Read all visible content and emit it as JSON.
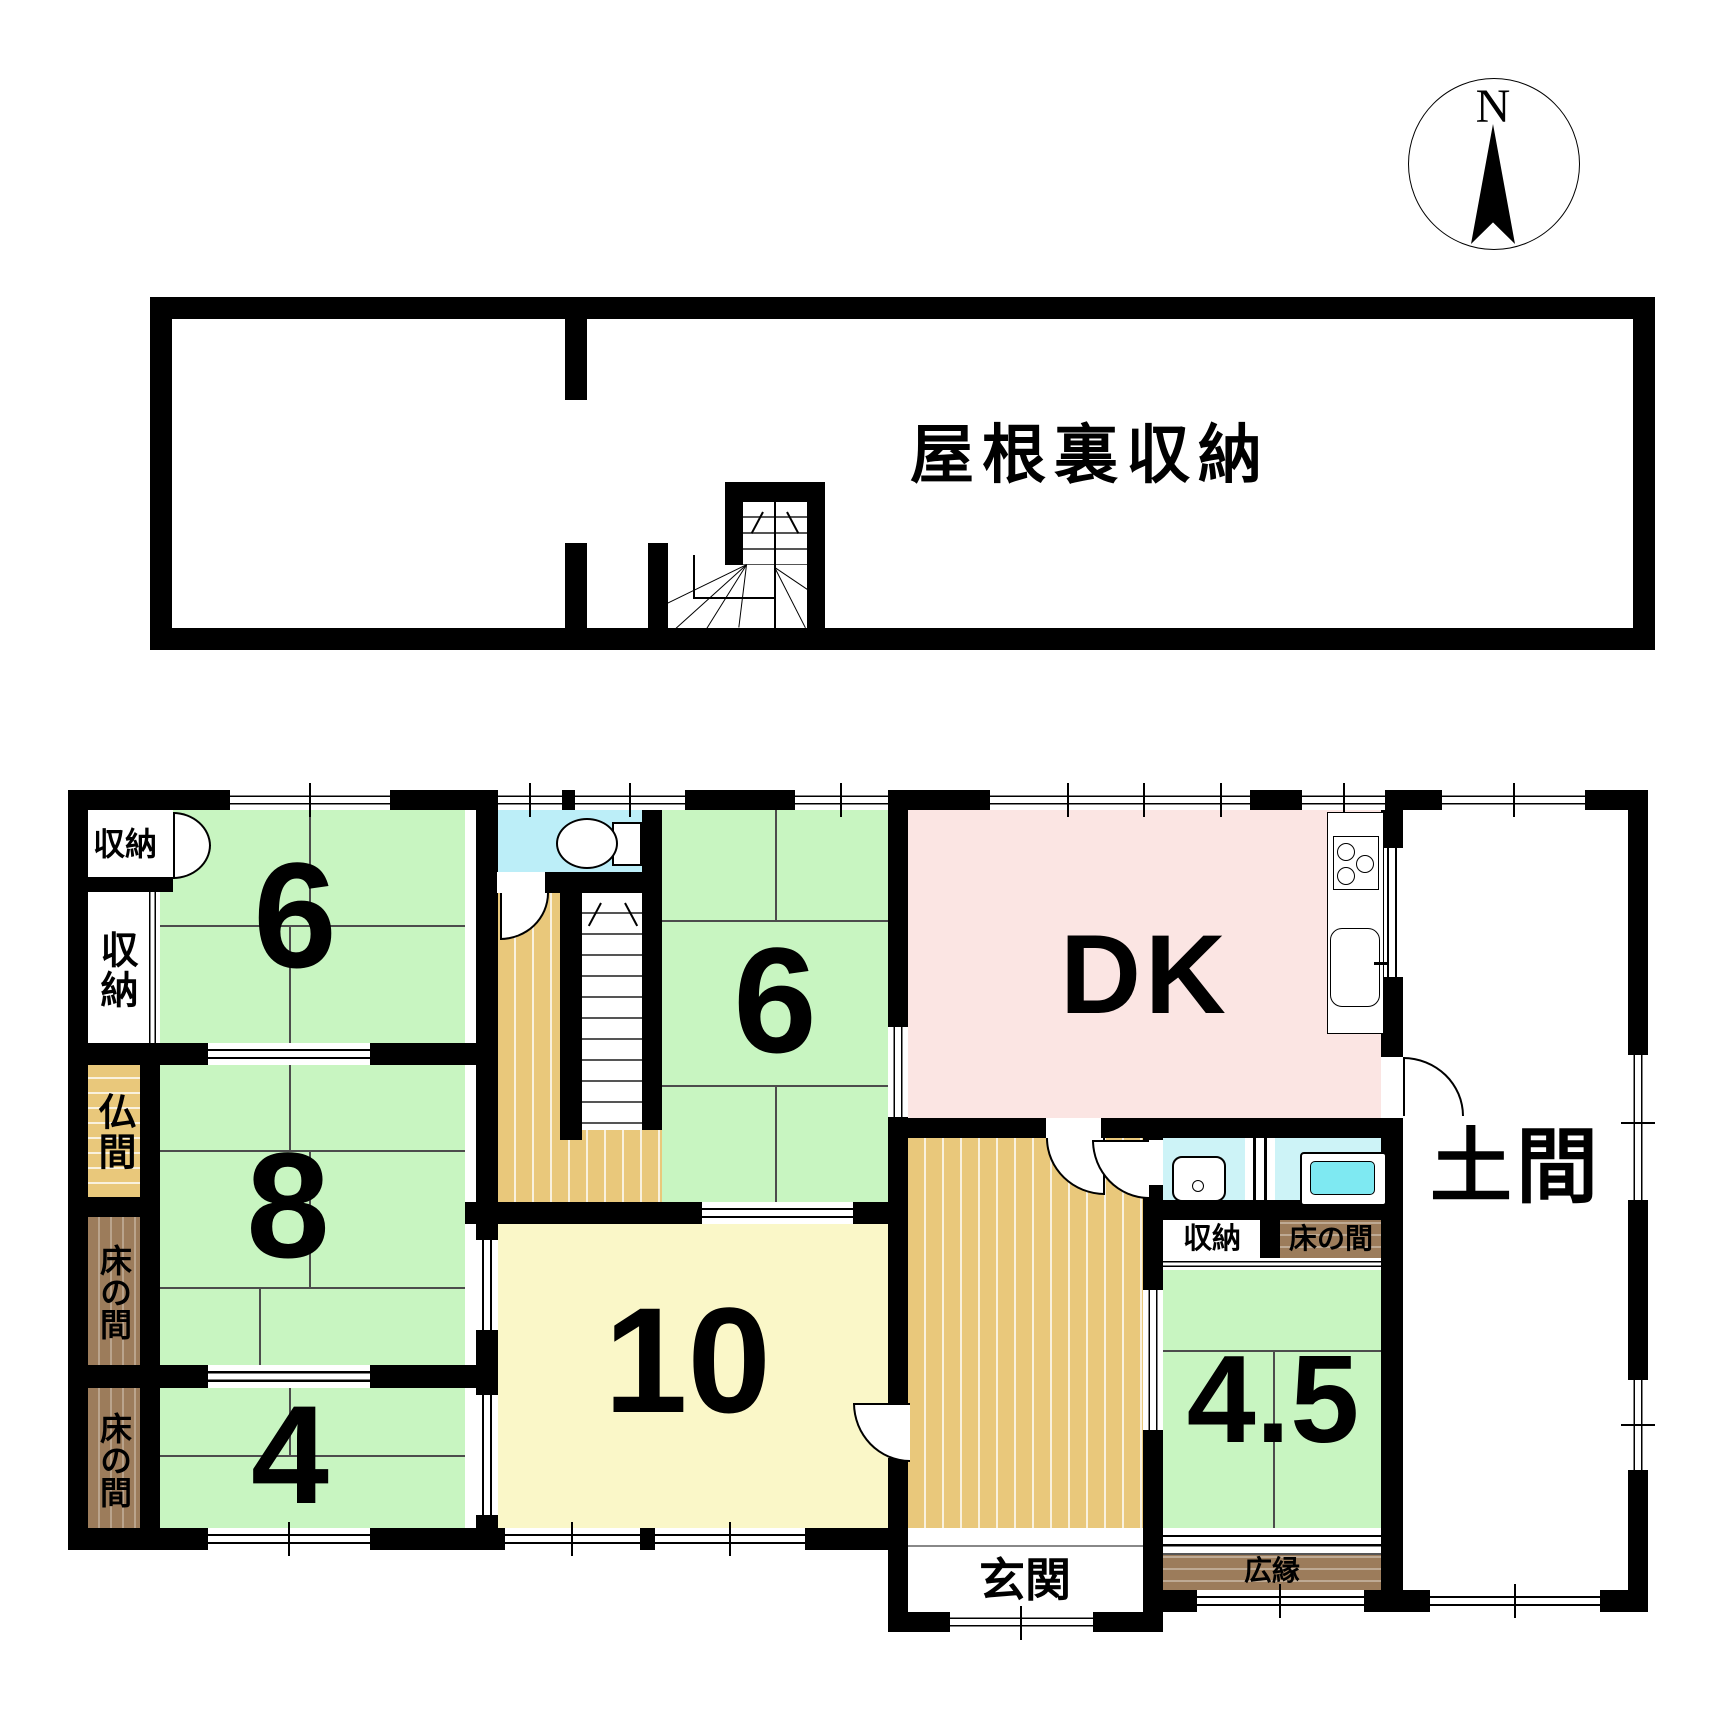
{
  "compass": {
    "label": "N"
  },
  "attic": {
    "label": "屋根裏収納"
  },
  "rooms": {
    "storage_tl": {
      "label": "収納"
    },
    "storage_left": {
      "label": "収納"
    },
    "butsuma": {
      "label": "仏間"
    },
    "tokonoma_upper": {
      "label": "床の間"
    },
    "tokonoma_lower": {
      "label": "床の間"
    },
    "tatami6_left": {
      "label": "6"
    },
    "tatami8": {
      "label": "8"
    },
    "tatami4": {
      "label": "4"
    },
    "tatami6_mid": {
      "label": "6"
    },
    "dk": {
      "label": "DK"
    },
    "tatami10": {
      "label": "10"
    },
    "tatami45": {
      "label": "4.5"
    },
    "doma": {
      "label": "土間"
    },
    "genkan": {
      "label": "玄関"
    },
    "storage_small": {
      "label": "収納"
    },
    "tokonoma_small": {
      "label": "床の間"
    },
    "hiroen": {
      "label": "広縁"
    }
  }
}
